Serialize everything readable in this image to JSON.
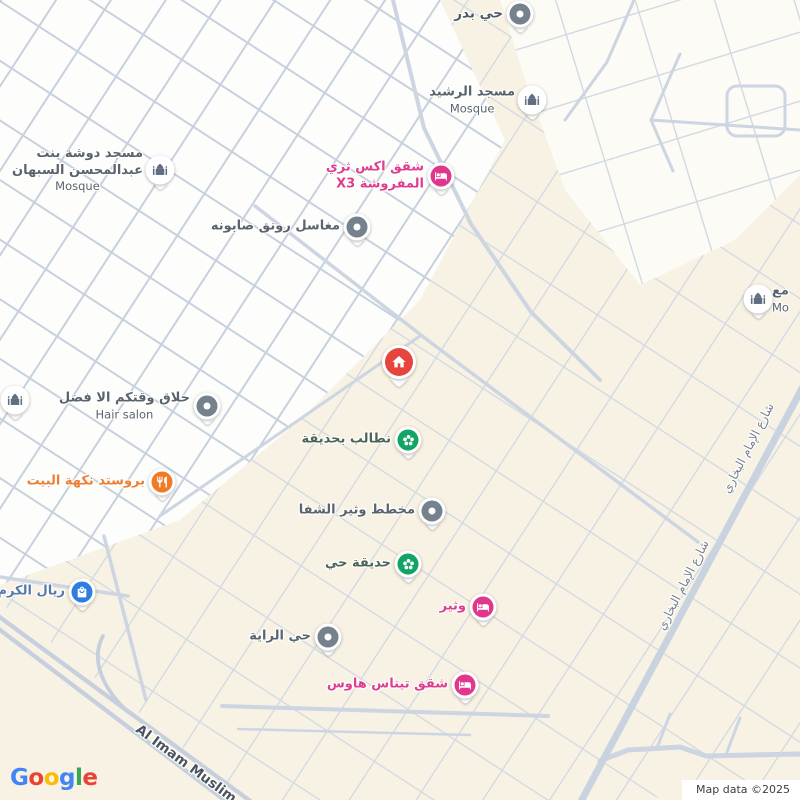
{
  "colors": {
    "map_background": "#f7f2e3",
    "street": "#cfd8e3",
    "white_blocks": "#fdfdfb",
    "lodging_accent": "#e0378d",
    "restaurant_accent": "#ef7b24",
    "shopping_accent": "#2f7de1",
    "park_accent": "#12a365",
    "generic_pin": "#76818e",
    "mosque_glyph": "#5f6e80",
    "property_pin": "#e5453c"
  },
  "pois": {
    "hay_badr": {
      "label": "حي بدر",
      "type": "district"
    },
    "masjid_rashid": {
      "label": "مسجد الرشيد",
      "sub": "Mosque",
      "type": "mosque"
    },
    "x3_apartments": {
      "label_line1": "شقق اكس ثري",
      "label_line2": "المفروشة X3",
      "type": "lodging"
    },
    "maghasil": {
      "label": "مغاسل رونق صابونه",
      "type": "generic"
    },
    "masjid_dosha": {
      "label_line1": "مسجد دوشة بنت",
      "label_line2": "عبدالمحسن السبهان",
      "sub": "Mosque",
      "type": "mosque"
    },
    "hair_salon": {
      "label": "حلاق وقتكم الا فضل",
      "sub": "Hair salon",
      "type": "generic"
    },
    "broasted": {
      "label": "بروستد نكهة البيت",
      "type": "restaurant"
    },
    "park_request": {
      "label": "نطالب بحديقة",
      "type": "park"
    },
    "mukhatat_wathir": {
      "label": "مخطط وثير الشفا",
      "type": "generic"
    },
    "hadiqat_hay": {
      "label": "حديقة حي",
      "type": "park"
    },
    "wathir": {
      "label": "وثير",
      "type": "lodging"
    },
    "rial_alkaram": {
      "label": "ريال الكرم",
      "type": "shopping"
    },
    "hay_alraya": {
      "label": "حي الراية",
      "type": "generic"
    },
    "tinas_house": {
      "label": "شقق تيناس هاوس",
      "type": "lodging"
    },
    "mosque_right_edge": {
      "label": "مع",
      "sub": "Mo",
      "type": "mosque"
    }
  },
  "roads": {
    "al_imam_muslim": "Al Imam Muslim",
    "imam_bukhari": "شارع الإمام البخاري"
  },
  "logo": {
    "letters": [
      {
        "ch": "G",
        "style": "color:#4285F4"
      },
      {
        "ch": "o",
        "style": "color:#EA4335"
      },
      {
        "ch": "o",
        "style": "color:#FBBC05"
      },
      {
        "ch": "g",
        "style": "color:#4285F4"
      },
      {
        "ch": "l",
        "style": "color:#34A853"
      },
      {
        "ch": "e",
        "style": "color:#EA4335"
      }
    ]
  },
  "attribution": "Map data ©2025"
}
